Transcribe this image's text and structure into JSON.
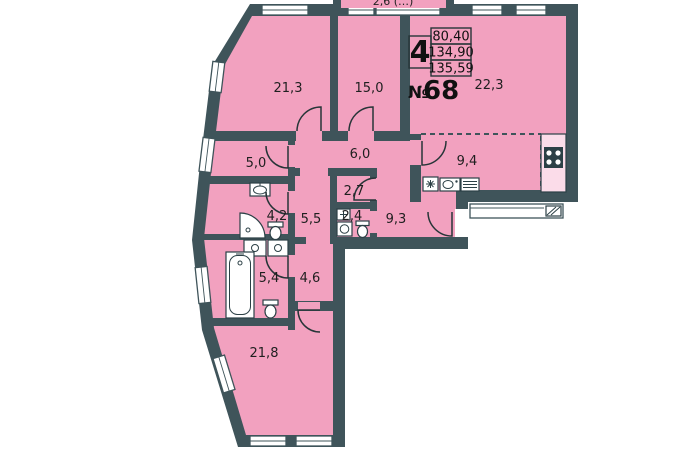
{
  "plan": {
    "info_box": {
      "rooms_count": "4",
      "area_living": "80,40",
      "area_total": "134,90",
      "area_total_with_balcony": "135,59",
      "unit_prefix": "№",
      "unit_number": "68"
    },
    "balcony": {
      "label": "2,6 (…)"
    },
    "rooms": {
      "bedroom_top_left": "21,3",
      "bedroom_top_mid": "15,0",
      "living_room": "22,3",
      "kitchen": "9,4",
      "storage": "5,0",
      "hall": "6,0",
      "closet": "2,7",
      "bathroom_small": "4,2",
      "hallway": "5,5",
      "wc": "2,4",
      "corridor_entry": "9,3",
      "bathroom_main": "5,4",
      "corridor_lower": "4,6",
      "bedroom_bottom": "21,8"
    },
    "colors": {
      "room_fill": "#f2a1bf",
      "wall": "#3f545a",
      "window": "#ffffff",
      "background": "#ffffff"
    }
  }
}
